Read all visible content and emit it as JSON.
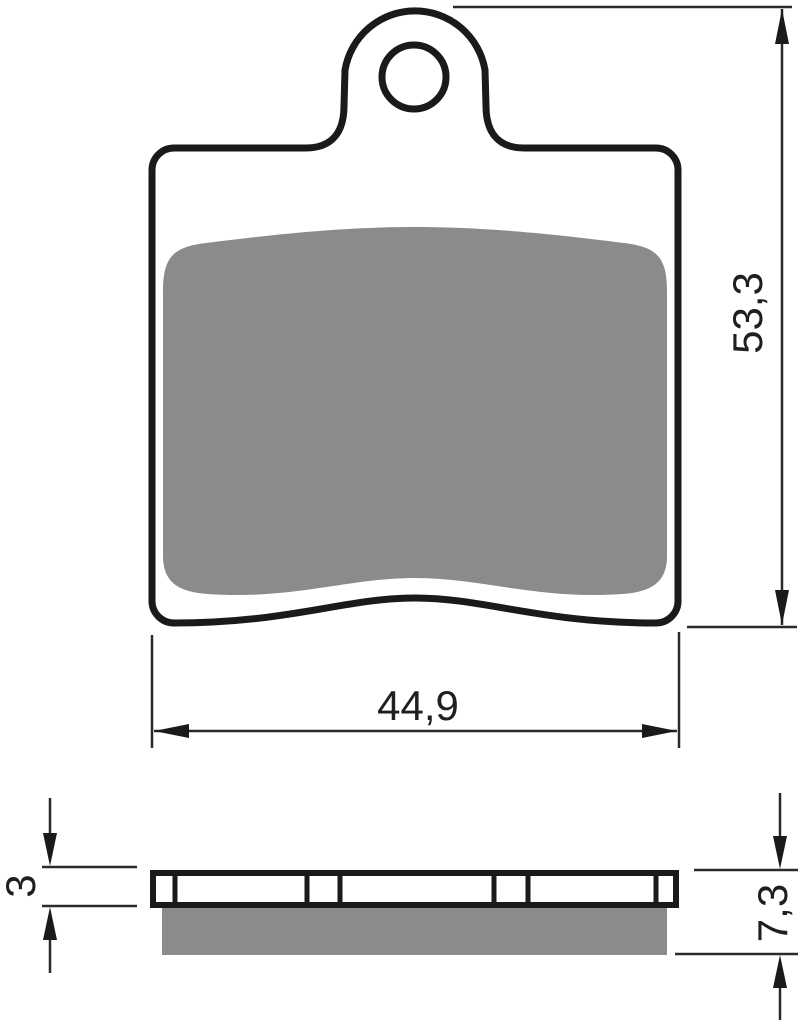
{
  "colors": {
    "outline": "#1a1a1a",
    "friction_gray": "#8b8b8b",
    "background": "#ffffff"
  },
  "drawing": {
    "subject": "brake-pad-dimension-drawing",
    "front_view": {
      "width_label": "44,9",
      "height_label": "53,3"
    },
    "side_view": {
      "backplate_thickness_label": "3",
      "total_thickness_label": "7,3"
    }
  }
}
